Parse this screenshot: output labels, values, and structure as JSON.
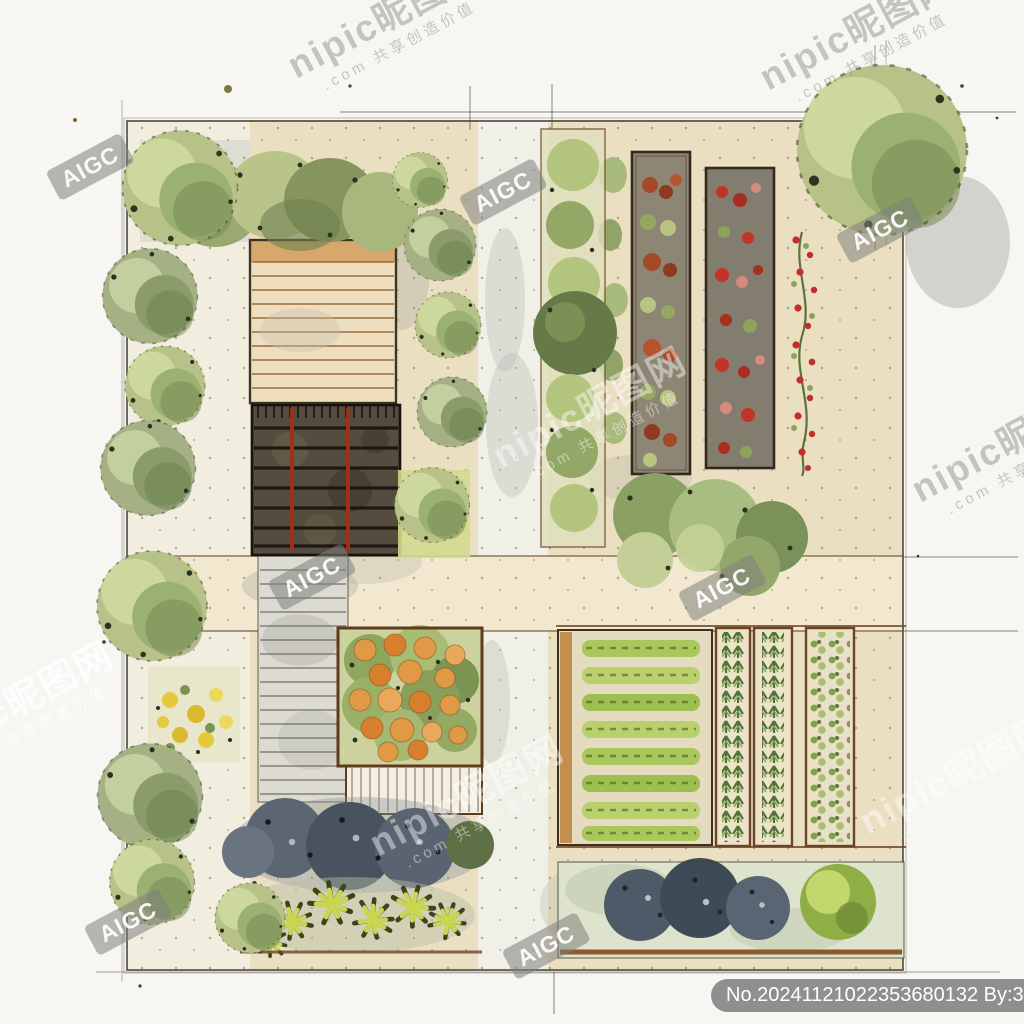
{
  "watermarks": {
    "nipic_main": "nipic昵图网",
    "nipic_sub": ".com 共享创造价值",
    "aigc": "AIGC"
  },
  "id_badge": {
    "text": "No.20241121022353680132 By:35479210"
  },
  "artwork": {
    "subject": "watercolor-ink garden landscape plan, top view",
    "palette": {
      "paper": "#f7f6f2",
      "ground_beige": "#ebdfc2",
      "path_light": "#f0f0e8",
      "stone_path_gray": "#dcdbd2",
      "deck_tan": "#eedec0",
      "deck_plank_brown": "#9a6a3d",
      "pergola_dark": "#554c3d",
      "pergola_red_beam": "#9e3019",
      "foliage_light": "#cdd89f",
      "foliage_mid": "#b6c287",
      "foliage_dark": "#778b52",
      "crop_green": "#a9c75b",
      "accent_red": "#c23526",
      "accent_orange": "#e09a45",
      "dark_shrub_blue": "#4f5a68",
      "spiky_yellow_green": "#c9d650",
      "yellow_flower": "#e5c93d",
      "wood_frame_brown": "#6b4426",
      "watermark_gray": "#8c8984",
      "badge_gray": "#898989"
    }
  }
}
